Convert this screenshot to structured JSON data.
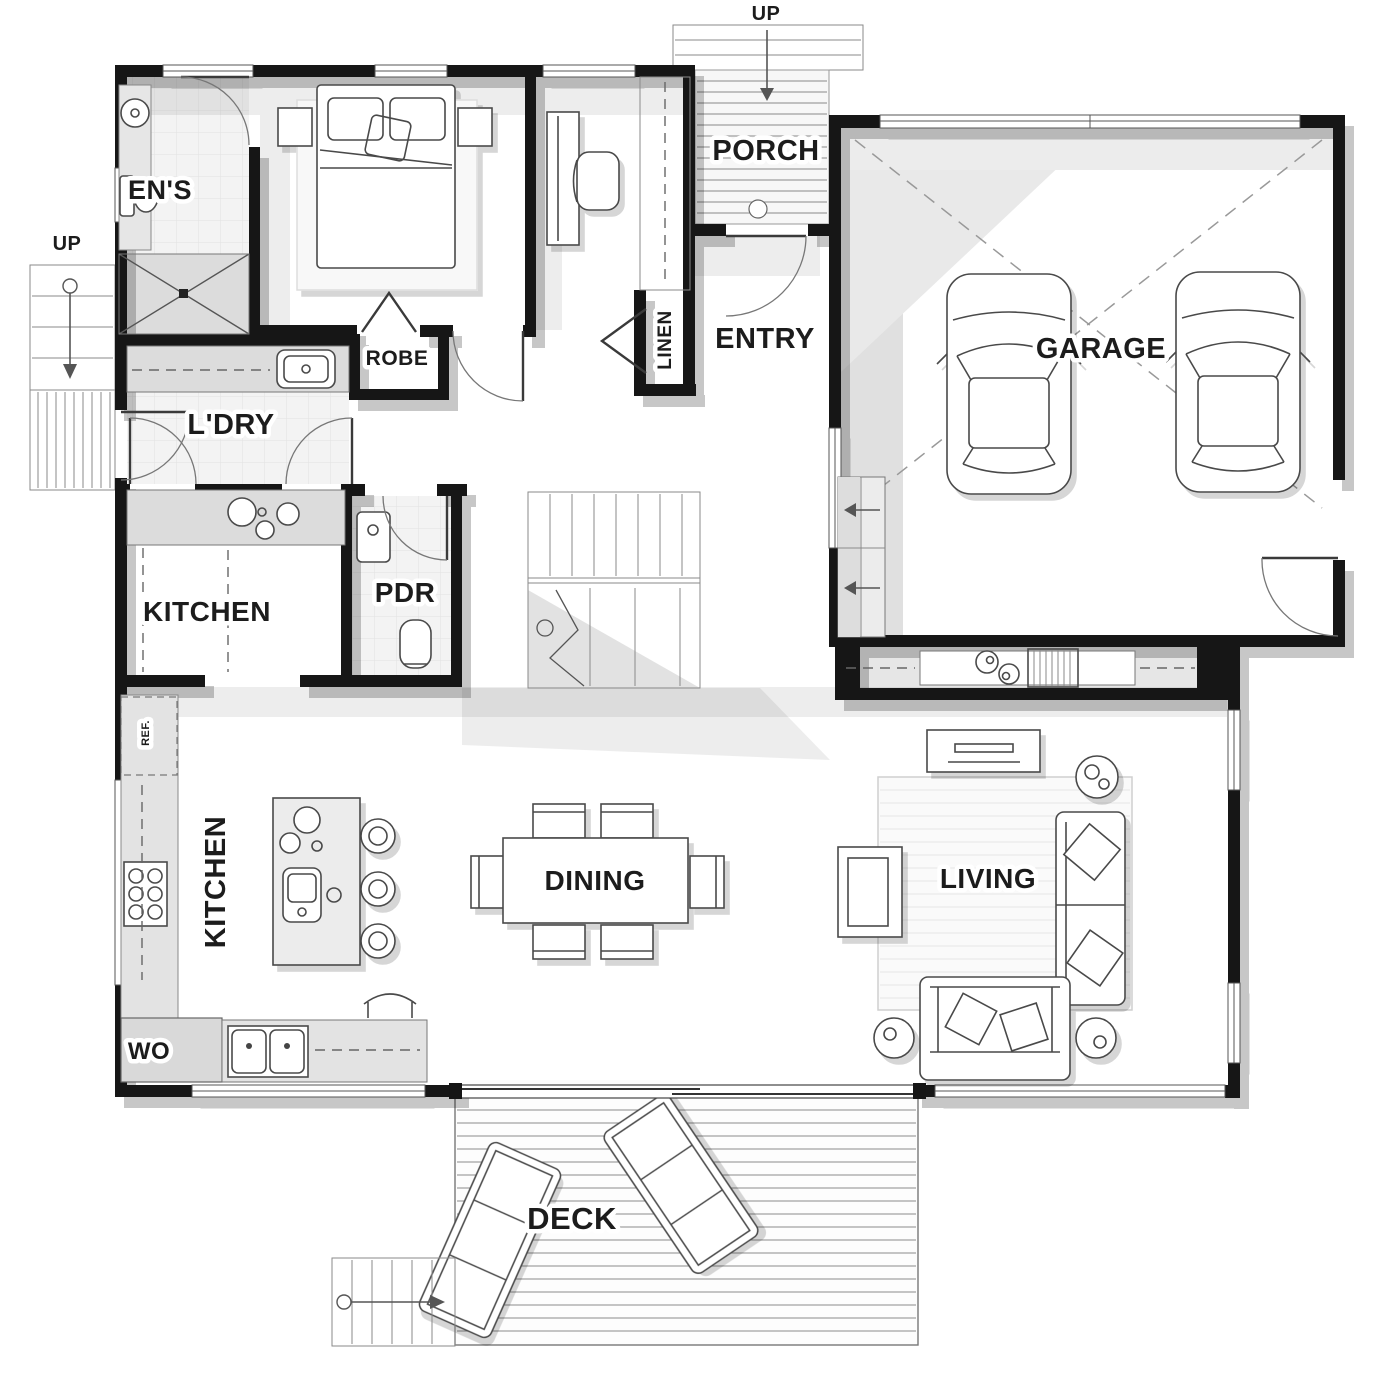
{
  "title": "Single storey house floor plan",
  "labels": {
    "ens": "EN'S",
    "ldry": "L'DRY",
    "robe": "ROBE",
    "linen": "LINEN",
    "porch": "PORCH",
    "entry": "ENTRY",
    "garage": "GARAGE",
    "kitchen_upper": "KITCHEN",
    "pdr": "PDR",
    "kitchen_main": "KITCHEN",
    "dining": "DINING",
    "living": "LIVING",
    "deck": "DECK",
    "wo": "WO",
    "ref": "REF.",
    "up_porch": "UP",
    "up_side": "UP"
  },
  "colors": {
    "wall": "#151515",
    "label": "#1c1c1c",
    "shade": "#e0e0e0",
    "line": "#4a4a4a",
    "light_line": "#9a9a9a",
    "paper": "#ffffff"
  }
}
